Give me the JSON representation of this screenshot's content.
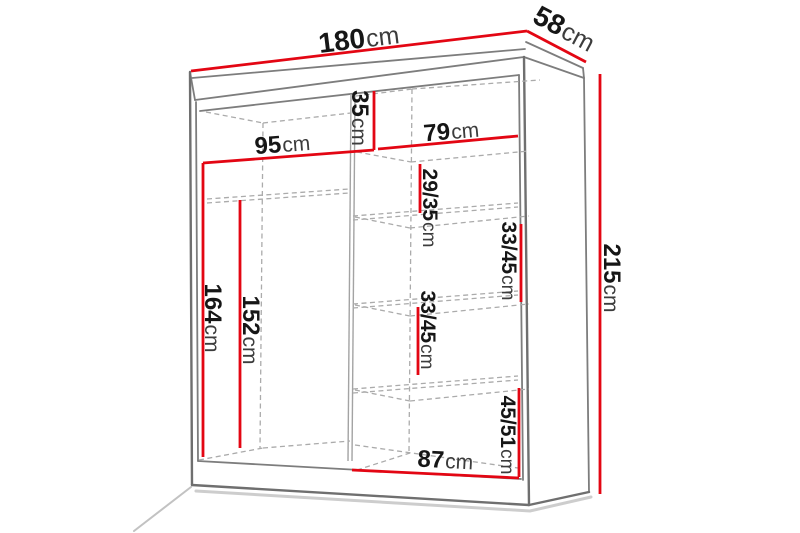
{
  "diagram": {
    "type": "furniture-dimension-diagram",
    "subject": "wardrobe with interior measurements",
    "unit": "cm",
    "colors": {
      "dimension_line": "#e30613",
      "outline_gray": "#7d7d7d",
      "dashed_gray": "#ababab",
      "label_text": "#161616",
      "background": "#ffffff"
    },
    "dimensions": {
      "width": {
        "value": "180",
        "unit": "cm"
      },
      "depth": {
        "value": "58",
        "unit": "cm"
      },
      "height": {
        "value": "215",
        "unit": "cm"
      },
      "left_section_width": {
        "value": "95",
        "unit": "cm"
      },
      "top_shelf_height": {
        "value": "35",
        "unit": "cm"
      },
      "right_section_width": {
        "value": "79",
        "unit": "cm"
      },
      "shelf_gap_top": {
        "value": "29/35",
        "unit": "cm"
      },
      "shelf_gap_upper": {
        "value": "33/45",
        "unit": "cm"
      },
      "shelf_gap_lower": {
        "value": "33/45",
        "unit": "cm"
      },
      "bottom_compartment": {
        "value": "45/51",
        "unit": "cm"
      },
      "left_inner_height": {
        "value": "164",
        "unit": "cm"
      },
      "hanging_height": {
        "value": "152",
        "unit": "cm"
      },
      "bottom_shelf_width": {
        "value": "87",
        "unit": "cm"
      }
    }
  }
}
